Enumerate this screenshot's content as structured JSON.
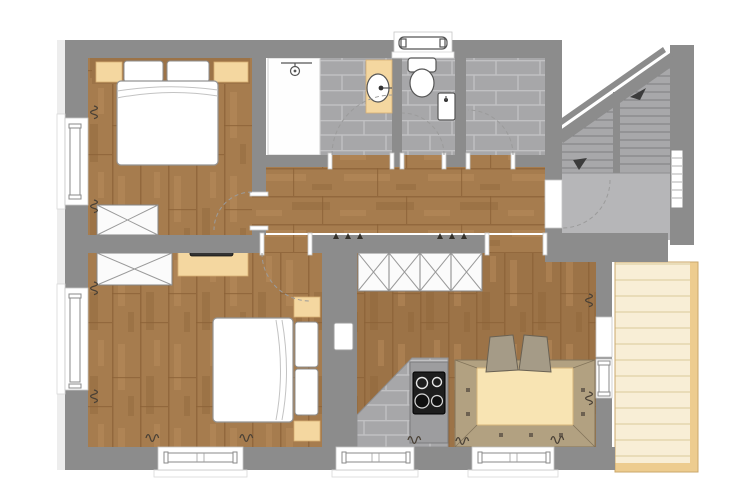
{
  "meta": {
    "type": "Architectural floor plan, top-down colour rendering of an apartment storey"
  },
  "colors": {
    "wall": "#8c8c8c",
    "landing": "#b6b6b8",
    "step": "#a8a8aa",
    "stepLine": "#7e7e80",
    "tile": "#a7a7a9",
    "tileLine": "#c1c1c3",
    "wood": "#a67c4e",
    "woodLight": "#b78c5c",
    "woodDark": "#8a6136",
    "woodKitchen": "#9c7347",
    "balcony": "#f8eed6",
    "balconyLine": "#e9dcb8",
    "balconyEdge": "#edcc8f",
    "tan": "#f4d7a0",
    "tanDark": "#d8b074",
    "bench": "#b2a181",
    "benchLine": "#83745a",
    "table": "#f8e4b3",
    "chair": "#a59b87",
    "cook": "#1e1e1e",
    "arc": "#9b9b9b",
    "squiggle": "#4a4136"
  },
  "rooms": [
    {
      "id": "bedroom-1",
      "position": "top-left",
      "floor": "wood-plank",
      "contents": [
        "double-bed",
        "two-pillows",
        "headboard-with-nightstands",
        "x-wardrobe",
        "window-with-radiator"
      ]
    },
    {
      "id": "bathroom",
      "position": "top-middle",
      "floor": "grey-tile",
      "contents": [
        "shower",
        "vanity-washbasin",
        "door-swing-arc"
      ]
    },
    {
      "id": "wc",
      "position": "top-middle-right",
      "floor": "grey-tile",
      "contents": [
        "toilet-with-cistern",
        "hand-basin",
        "window-above"
      ]
    },
    {
      "id": "storage-room",
      "position": "top-right-of-wc",
      "floor": "grey-tile",
      "contents": [
        "door-swing-arc"
      ]
    },
    {
      "id": "staircase",
      "position": "top-right",
      "floor": "concrete-grey",
      "contents": [
        "two-flights",
        "direction-arrows",
        "landing",
        "radiator",
        "entrance-door-arc"
      ]
    },
    {
      "id": "hallway",
      "position": "centre",
      "floor": "wood-plank-horizontal",
      "contents": [
        "door-openings",
        "wall-hooks"
      ]
    },
    {
      "id": "bedroom-2",
      "position": "bottom-left",
      "floor": "wood-plank",
      "contents": [
        "double-bed",
        "two-pillows",
        "two-nightstands",
        "x-wardrobe",
        "desk-with-tv",
        "two-windows"
      ]
    },
    {
      "id": "kitchen-living",
      "position": "bottom-right",
      "floor": "wood-plank-and-tile",
      "contents": [
        "x-wardrobe-row",
        "kitchen-counter",
        "cooktop-4-burners",
        "corner-bench",
        "dining-table",
        "two-chairs",
        "balcony-door",
        "window"
      ]
    },
    {
      "id": "balcony",
      "position": "right",
      "floor": "light-wood-decking",
      "contents": [
        "deck-boards",
        "edge-frame"
      ]
    }
  ]
}
